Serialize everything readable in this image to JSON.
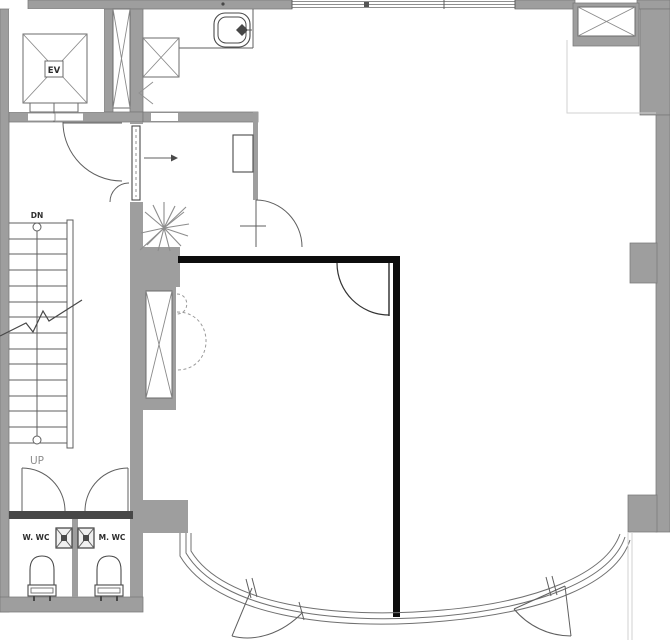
{
  "labels": {
    "elevator": "EV",
    "stair_down": "DN",
    "stair_up": "UP",
    "wc_left": "W. WC",
    "wc_right": "M. WC"
  },
  "colors": {
    "wall_fill": "#9e9e9e",
    "wall_dark": "#474747",
    "partition_black": "#0d0d0d",
    "line": "#5f5f5f",
    "background": "#ffffff"
  },
  "symbols": {
    "elevator_shaft": "x-cross-box",
    "duct_shafts": "x-cross-box",
    "stairs": "treads-with-break-line",
    "doors": "quarter-circle-swing-arc",
    "sliding_door": "pocket-panel-with-arrow",
    "kitchen_sink": "rounded-basin-with-faucet",
    "toilets": "bowl-with-tank",
    "wash_basins": "x-marked-basin-box",
    "plant": "radial-leaf-burst",
    "south_facade": "curved-curtain-wall-glazing"
  }
}
